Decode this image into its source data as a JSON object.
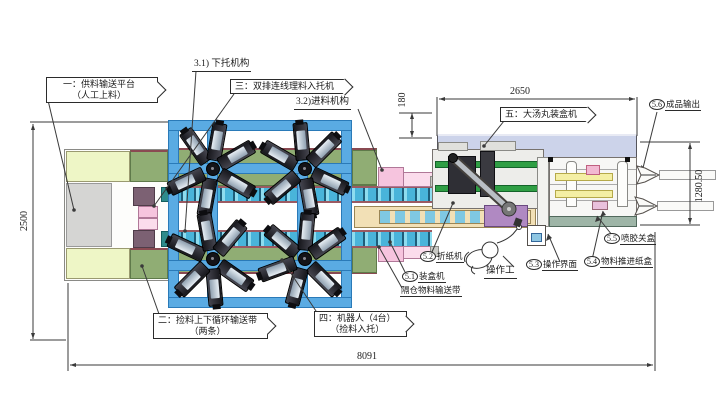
{
  "title_note": "packaging line layout drawing (top view)",
  "callouts": {
    "c1": {
      "line1": "一：供料输送平台",
      "line2": "（人工上料）"
    },
    "c2": {
      "line1": "二：捡料上下循环输送带",
      "line2": "（两条）"
    },
    "c3": {
      "line1": "三：双排连线理料入托机"
    },
    "c4": {
      "line1": "四：机器人（4台）",
      "line2": "（捡料入托）"
    },
    "c5": {
      "line1": "五：大汤丸装盒机"
    }
  },
  "plain_labels": {
    "l31": "3.1) 下托机构",
    "l32": "3.2)进料机构",
    "operator": "操作工",
    "l51_line2": "隔仓物料输送带"
  },
  "circled_labels": {
    "s51": {
      "num": "5.1",
      "text": "装盒机"
    },
    "s52": {
      "num": "5.2",
      "text": "折纸机"
    },
    "s53": {
      "num": "5.3",
      "text": "操作界面"
    },
    "s54": {
      "num": "5.4",
      "text": "物料推进纸盒"
    },
    "s55": {
      "num": "5.5",
      "text": "喷胶关盒"
    },
    "s56": {
      "num": "5.6",
      "text": "成品输出"
    }
  },
  "dimensions": {
    "total_length": "8091",
    "platform_depth": "2500",
    "cartoner_length": "2650",
    "infeed_offset": "180",
    "cartoner_width": "1280.50"
  },
  "colors": {
    "frame_blue": "#5aabe3",
    "belt_cyan": "#49b4da",
    "band_green": "#90ad74",
    "panel_lavender": "#ccd3ea",
    "platform_yellow": "#eef6c6",
    "platform_gray": "#d5d5d3",
    "pink": "#f6c4de",
    "mauve": "#7c6173",
    "tan_conveyor": "#f2e0b6",
    "machine_base_green": "#9eb5a7",
    "fold_belt_green": "#2f9e44",
    "robot_dark": "#26262c",
    "purple_block": "#b089c2"
  }
}
